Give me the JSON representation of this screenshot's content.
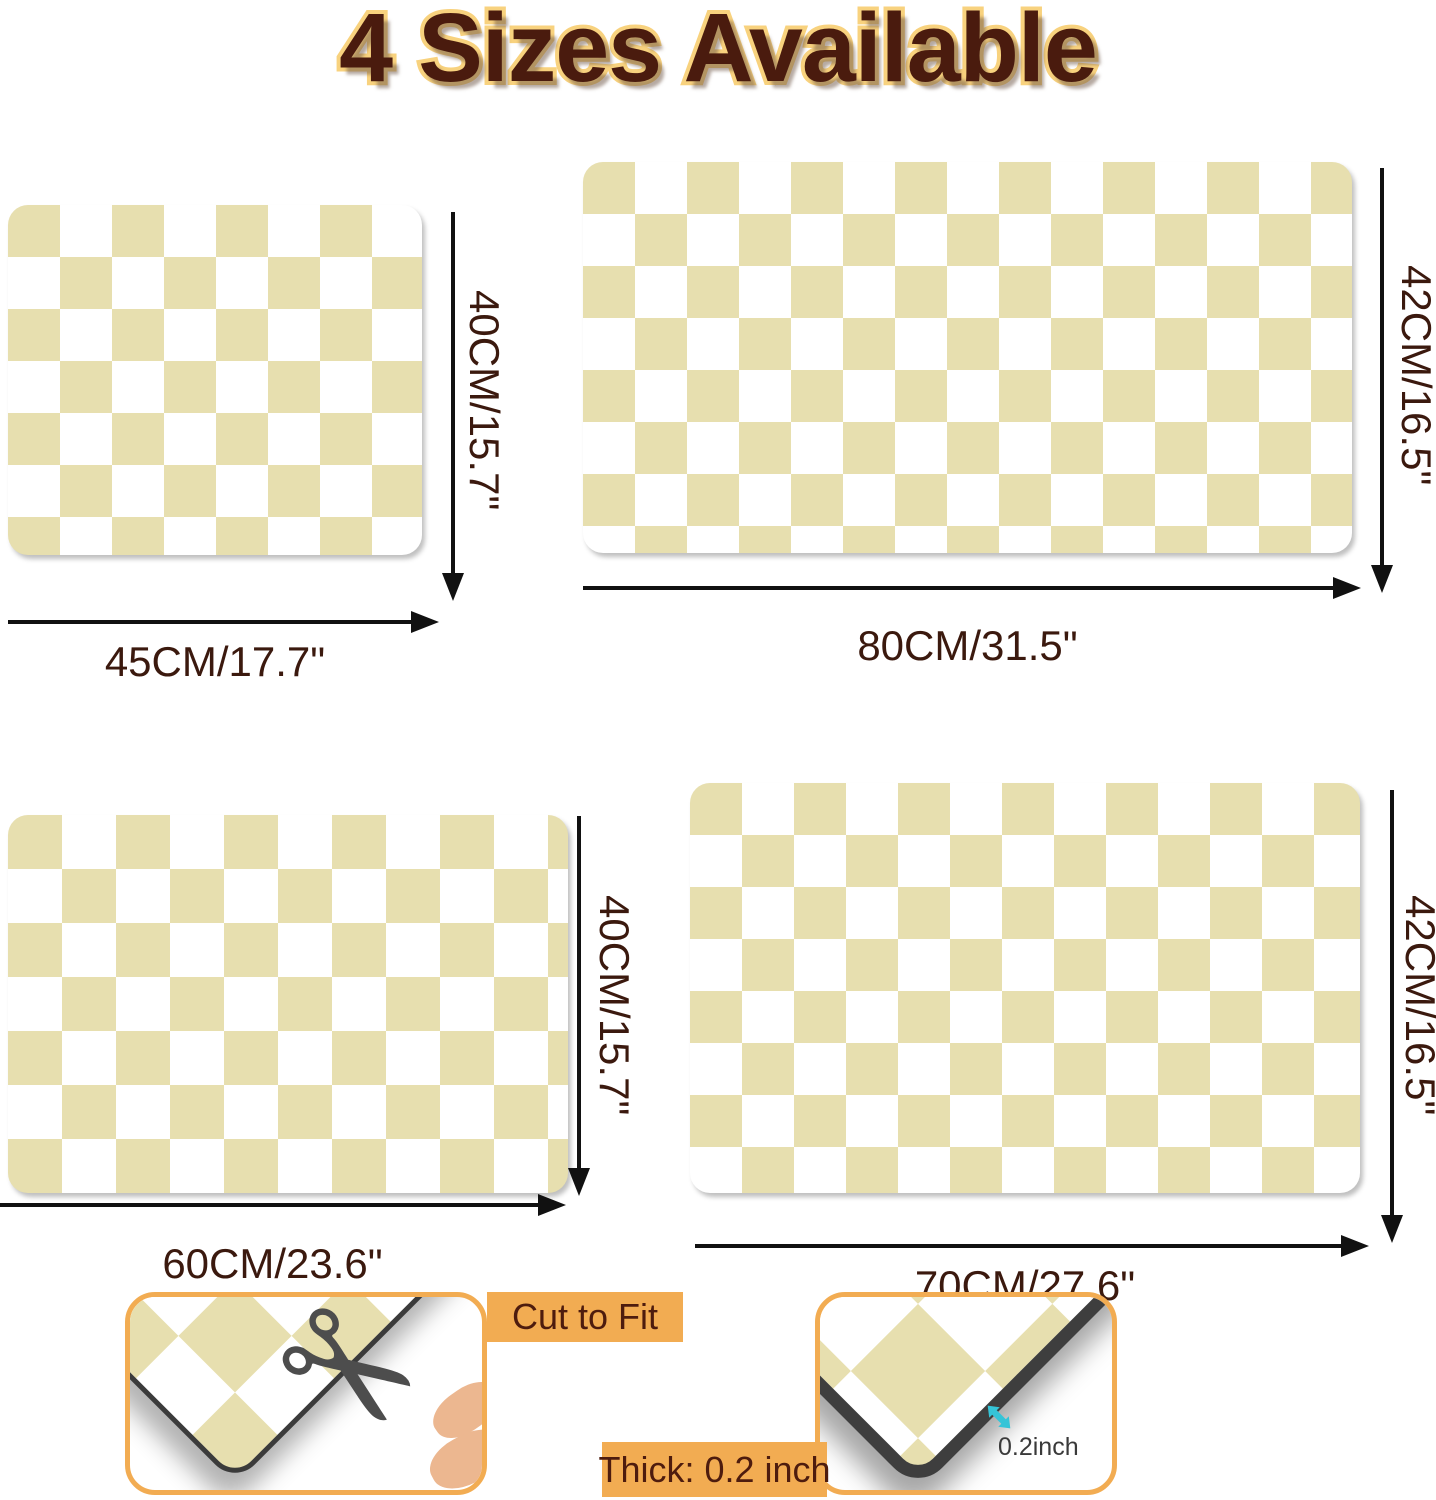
{
  "title": "4 Sizes Available",
  "mats": [
    {
      "name": "small",
      "width_label": "45CM/17.7\"",
      "height_label": "40CM/15.7\""
    },
    {
      "name": "extra-large",
      "width_label": "80CM/31.5\"",
      "height_label": "42CM/16.5\""
    },
    {
      "name": "medium",
      "width_label": "60CM/23.6\"",
      "height_label": "40CM/15.7\""
    },
    {
      "name": "large",
      "width_label": "70CM/27.6\"",
      "height_label": "42CM/16.5\""
    }
  ],
  "insets": {
    "cut_to_fit": {
      "label": "Cut to Fit"
    },
    "thickness": {
      "label": "Thick: 0.2 inch",
      "marker_text": "0.2inch"
    }
  },
  "icons": {
    "scissors": "✂"
  },
  "colors": {
    "beige": "#E7DFAF",
    "mat_white": "#FFFFFF",
    "accent_orange": "#F2AC52",
    "label_text": "#4E1C0E",
    "dimension_text": "#3B190E",
    "title_fill": "#4A1B0E",
    "title_stroke": "#F8D27E",
    "arrow_black": "#111111",
    "marker_cyan": "#35C4D7"
  }
}
